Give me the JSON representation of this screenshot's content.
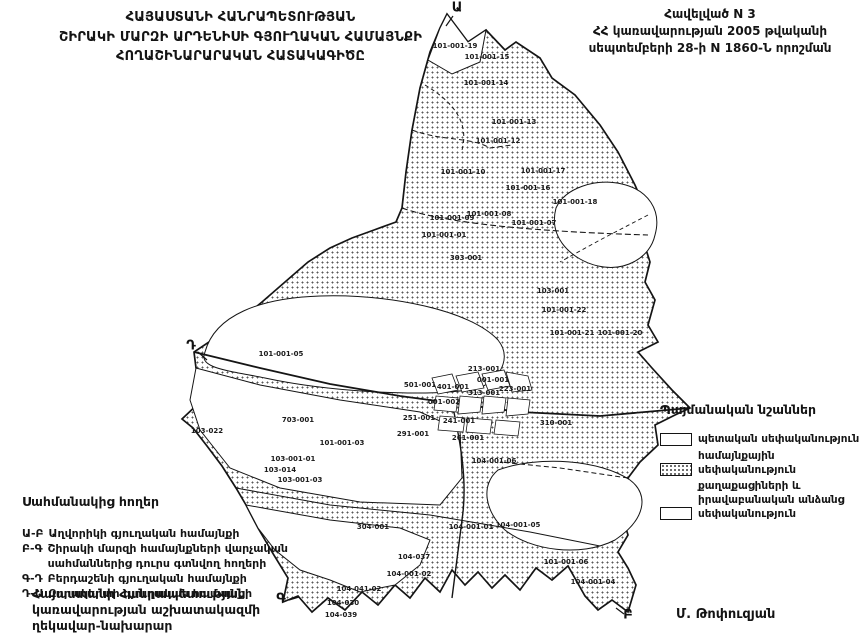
{
  "colors": {
    "ink": "#141414",
    "paper": "#ffffff",
    "stipple": "#585858"
  },
  "header": {
    "title_lines": [
      "ՀԱՅԱՍՏԱՆԻ ՀԱՆՐԱՊԵՏՈՒԹՅԱՆ",
      "ՇԻՐԱԿԻ ՄԱՐԶԻ ԱՐԴԵՆԻՍԻ ԳՅՈՒՂԱԿԱՆ ՀԱՄԱՅՆՔԻ",
      "ՀՈՂԱՇԻՆԱՐԱՐԱԿԱՆ ՀԱՏԱԿԱԳԻԾԸ"
    ],
    "appendix_lines": [
      "Հավելված N 3",
      "ՀՀ կառավարության 2005 թվականի",
      "սեպտեմբերի 28-ի N 1860-Ն որոշման"
    ]
  },
  "legend": {
    "title": "Պայմանական նշաններ",
    "items": [
      {
        "swatch": "plain",
        "label": "պետական սեփականություն"
      },
      {
        "swatch": "dotted",
        "label": "համայնքային սեփականություն"
      },
      {
        "swatch": "plain",
        "label": "քաղաքացիների և իրավաբանական անձանց սեփականություն"
      }
    ]
  },
  "adjacent_lands": {
    "title": "Սահմանակից հողեր",
    "items": [
      {
        "code": "Ա-Բ",
        "label": "Աղվորիկի գյուղական համայնքի"
      },
      {
        "code": "Բ-Գ",
        "label": "Շիրակի մարզի համայնքների վարչական սահմաններից դուրս գտնվող հողերի"
      },
      {
        "code": "Գ-Դ",
        "label": "Բերդաշենի գյուղական համայնքի"
      },
      {
        "code": "Դ-Ա",
        "label": "Զորակերտի գյուղական համայնքի"
      }
    ]
  },
  "signature": {
    "lines": [
      "Հայաստանի Հանրապետության",
      "կառավարության աշխատակազմի",
      "ղեկավար-նախարար"
    ],
    "name": "Մ. Թոփուզյան"
  },
  "map": {
    "boundary_points": [
      {
        "letter": "Ա",
        "x": 457,
        "y": 8
      },
      {
        "letter": "Դ",
        "x": 191,
        "y": 346
      },
      {
        "letter": "Գ",
        "x": 281,
        "y": 599
      },
      {
        "letter": "Բ",
        "x": 628,
        "y": 615
      }
    ],
    "parcel_labels": [
      {
        "text": "101-001-19",
        "x": 455,
        "y": 46
      },
      {
        "text": "101-001-15",
        "x": 487,
        "y": 57
      },
      {
        "text": "101-001-14",
        "x": 486,
        "y": 83
      },
      {
        "text": "101-001-13",
        "x": 514,
        "y": 122
      },
      {
        "text": "101-001-12",
        "x": 498,
        "y": 141
      },
      {
        "text": "101-001-10",
        "x": 463,
        "y": 172
      },
      {
        "text": "101-001-17",
        "x": 543,
        "y": 171
      },
      {
        "text": "101-001-16",
        "x": 528,
        "y": 188
      },
      {
        "text": "101-001-18",
        "x": 575,
        "y": 202
      },
      {
        "text": "101-001-09",
        "x": 452,
        "y": 218
      },
      {
        "text": "101-001-08",
        "x": 489,
        "y": 214
      },
      {
        "text": "101-001-07",
        "x": 534,
        "y": 223
      },
      {
        "text": "101-001-01",
        "x": 444,
        "y": 235
      },
      {
        "text": "303-001",
        "x": 466,
        "y": 258
      },
      {
        "text": "103-001",
        "x": 553,
        "y": 291
      },
      {
        "text": "101-001-22",
        "x": 564,
        "y": 310
      },
      {
        "text": "101-001-21",
        "x": 572,
        "y": 333
      },
      {
        "text": "101-001-20",
        "x": 620,
        "y": 333
      },
      {
        "text": "101-001-05",
        "x": 281,
        "y": 354
      },
      {
        "text": "213-001",
        "x": 484,
        "y": 369
      },
      {
        "text": "001-001",
        "x": 493,
        "y": 380
      },
      {
        "text": "223-001",
        "x": 515,
        "y": 389
      },
      {
        "text": "401-001",
        "x": 453,
        "y": 387
      },
      {
        "text": "313-001",
        "x": 484,
        "y": 393
      },
      {
        "text": "501-001",
        "x": 420,
        "y": 385
      },
      {
        "text": "001-002",
        "x": 444,
        "y": 402
      },
      {
        "text": "291-001",
        "x": 413,
        "y": 434
      },
      {
        "text": "241-001",
        "x": 459,
        "y": 421
      },
      {
        "text": "251-001",
        "x": 419,
        "y": 418
      },
      {
        "text": "261-001",
        "x": 468,
        "y": 438
      },
      {
        "text": "310-001",
        "x": 556,
        "y": 423
      },
      {
        "text": "103-022",
        "x": 207,
        "y": 431
      },
      {
        "text": "703-001",
        "x": 298,
        "y": 420
      },
      {
        "text": "103-001-01",
        "x": 293,
        "y": 459
      },
      {
        "text": "103-014",
        "x": 280,
        "y": 470
      },
      {
        "text": "103-001-03",
        "x": 300,
        "y": 480
      },
      {
        "text": "101-001-03",
        "x": 342,
        "y": 443
      },
      {
        "text": "104-001-06",
        "x": 494,
        "y": 461
      },
      {
        "text": "304-001",
        "x": 373,
        "y": 527
      },
      {
        "text": "104-001-01",
        "x": 471,
        "y": 527
      },
      {
        "text": "104-001-05",
        "x": 518,
        "y": 525
      },
      {
        "text": "104-037",
        "x": 414,
        "y": 557
      },
      {
        "text": "104-001-02",
        "x": 409,
        "y": 574
      },
      {
        "text": "104-041-02",
        "x": 359,
        "y": 589
      },
      {
        "text": "104-030",
        "x": 343,
        "y": 603
      },
      {
        "text": "104-039",
        "x": 341,
        "y": 615
      },
      {
        "text": "101-001-06",
        "x": 566,
        "y": 562
      },
      {
        "text": "104-001-04",
        "x": 593,
        "y": 582
      }
    ]
  }
}
